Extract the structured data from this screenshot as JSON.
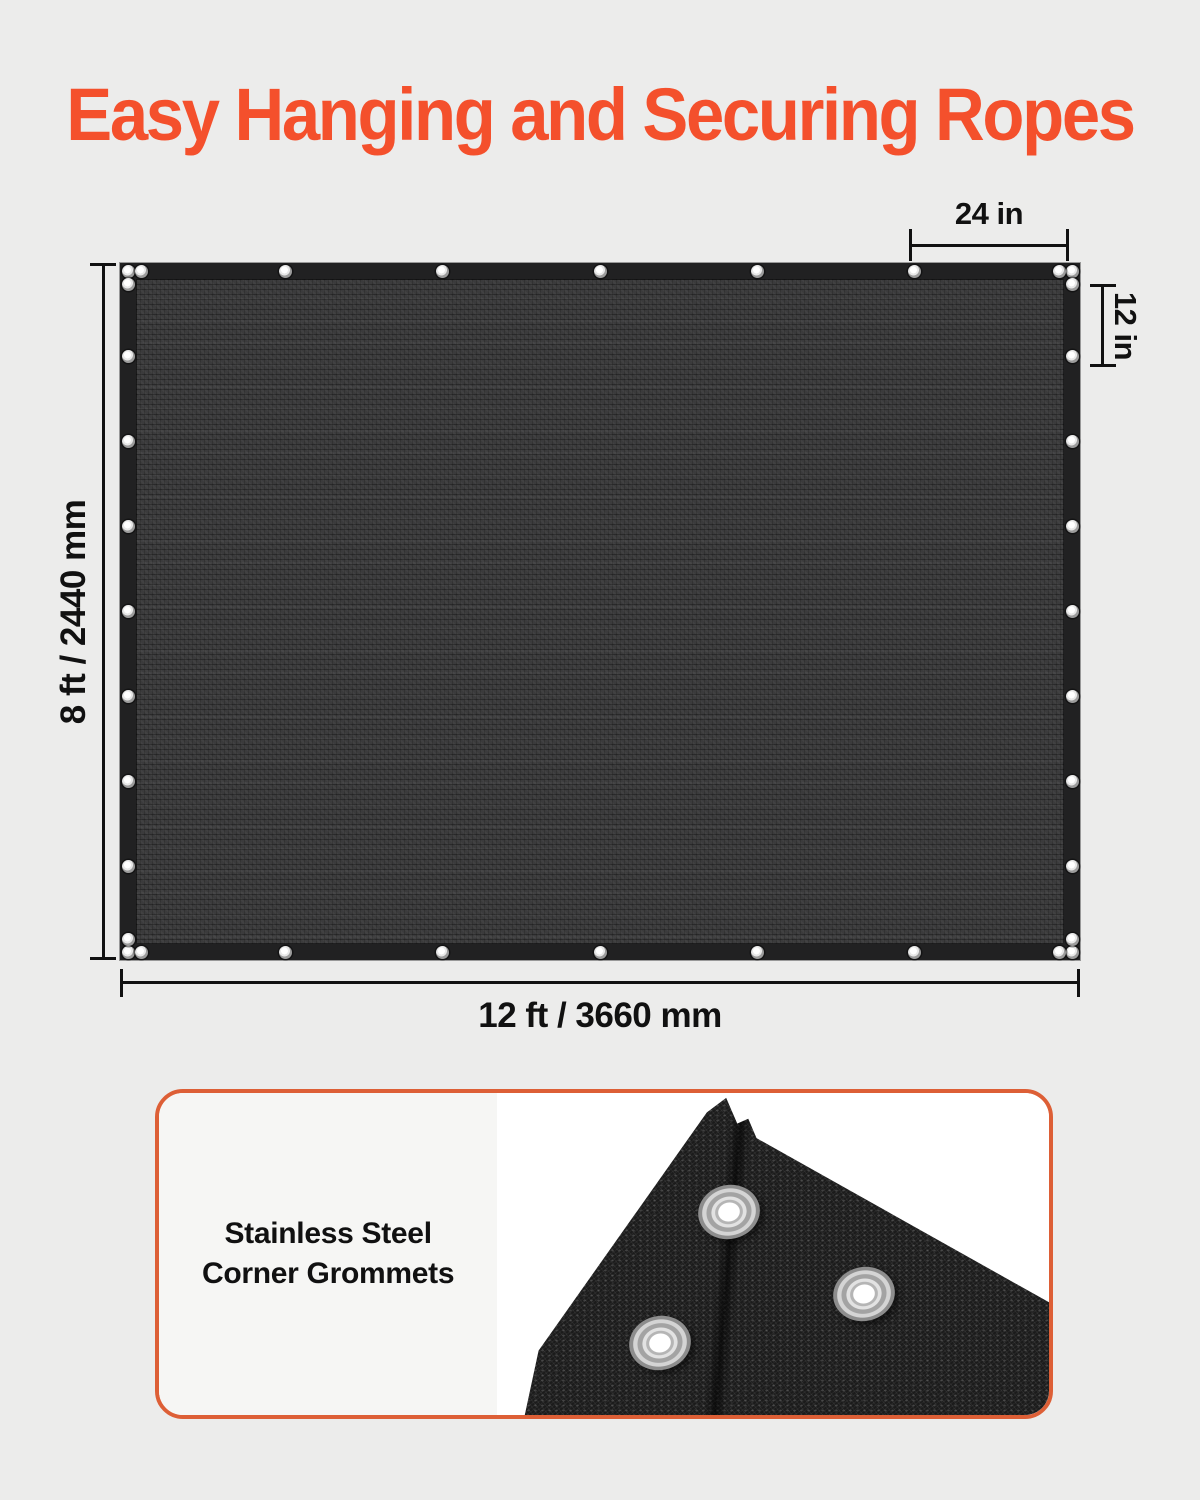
{
  "title": "Easy Hanging and Securing Ropes",
  "colors": {
    "accent": "#F4502C",
    "card_border": "#DD5F36",
    "background": "#ECECEB",
    "tarp_mesh": "#3B3B3C",
    "tarp_band": "#212122",
    "dimension_ink": "#111111"
  },
  "diagram": {
    "grommet_spacing_top": "24 in",
    "grommet_spacing_side": "12 in",
    "tarp_height": "8 ft / 2440 mm",
    "tarp_width": "12 ft / 3660 mm"
  },
  "feature_card": {
    "lines": [
      "Stainless Steel",
      "Corner Grommets"
    ]
  }
}
